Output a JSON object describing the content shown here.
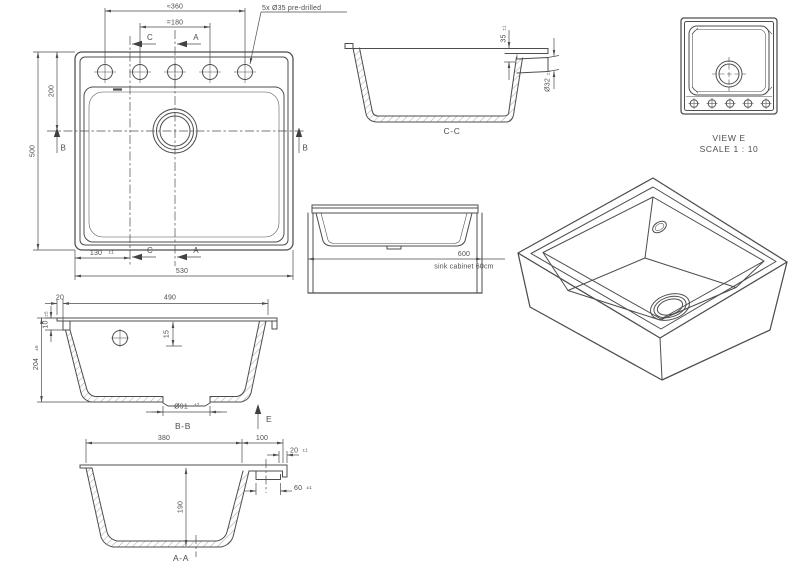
{
  "colors": {
    "line": "#4d4d4d",
    "text": "#4d4d4d",
    "background": "#ffffff"
  },
  "plan": {
    "dim360": "≈360",
    "dim180": "=180",
    "note": "5x Ø35 pre-drilled",
    "dim200": "200",
    "dim500": "500",
    "dim130": "130",
    "tol130": "±1",
    "dim530": "530",
    "c": "C",
    "a": "A",
    "b": "B"
  },
  "cc": {
    "label": "C-C",
    "dim35": "35",
    "tol35": "±1",
    "dim32": "Ø32",
    "tol32": "±1"
  },
  "viewe": {
    "line1": "VIEW E",
    "line2": "SCALE 1 : 10"
  },
  "cabinet": {
    "dim600": "600",
    "note": "sink cabinet 60cm"
  },
  "bb": {
    "label": "B-B",
    "dim20": "20",
    "dim490": "490",
    "dim10": "10",
    "tol10": "±5",
    "dim204": "204",
    "tol204": "±5",
    "dim15": "15",
    "dim91": "Ø91",
    "tol91": "+2",
    "e": "E"
  },
  "aa": {
    "label": "A-A",
    "dim380": "380",
    "dim100": "100",
    "dim20": "20",
    "tol20": "±1",
    "dim60": "60",
    "tol60": "±1",
    "dim190": "190"
  }
}
